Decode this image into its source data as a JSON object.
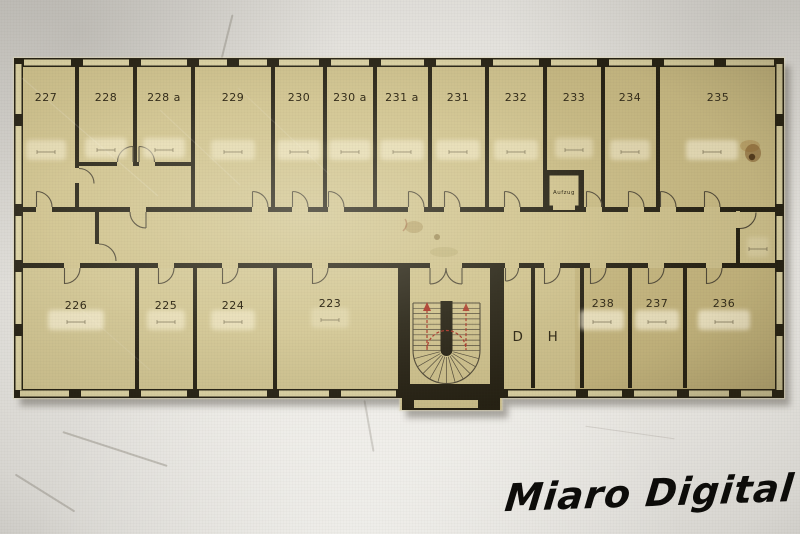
{
  "floor_plan": {
    "rooms": [
      "227",
      "228",
      "228 a",
      "229",
      "230",
      "230 a",
      "231 a",
      "231",
      "232",
      "233",
      "234",
      "235",
      "226",
      "225",
      "224",
      "223",
      "D",
      "H",
      "238",
      "237",
      "236"
    ],
    "elevator_label": "Aufzug"
  },
  "watermark": "Miaro Digital",
  "colors": {
    "paper_beige": "#cfc28e",
    "window_strip": "#ddd4a6",
    "wall_ink": "#221e12",
    "stair_red": "#a93226",
    "watermark_ink": "#0c0b09"
  }
}
